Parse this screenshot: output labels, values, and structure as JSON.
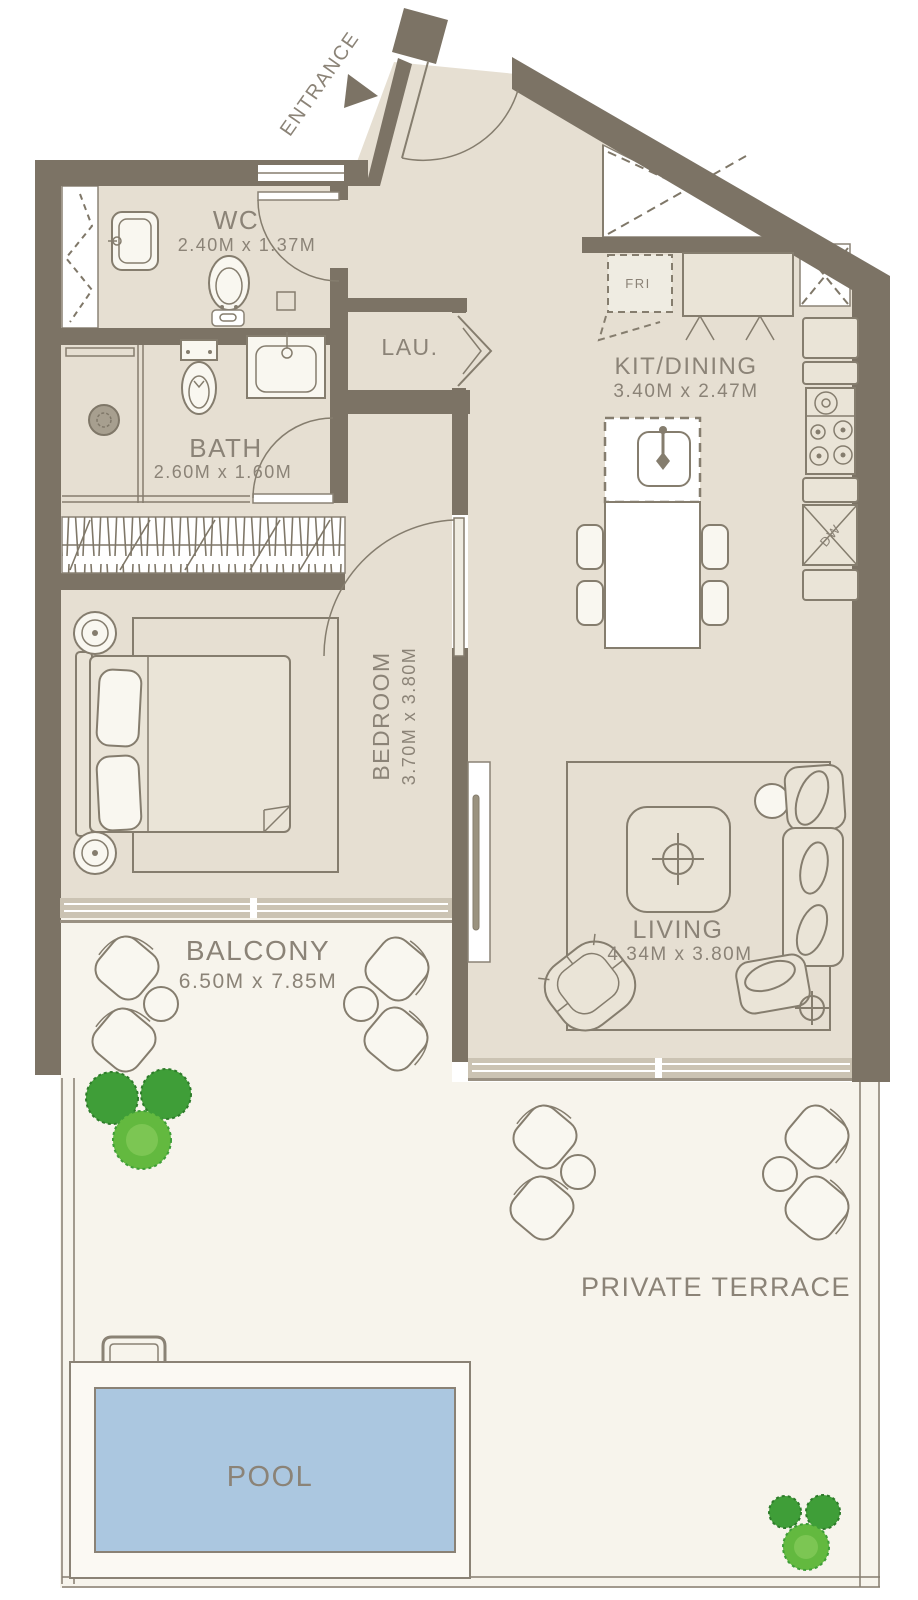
{
  "plan": {
    "entrance": {
      "label": "ENTRANCE"
    },
    "rooms": {
      "wc": {
        "name": "WC",
        "dims": "2.40M x 1.37M"
      },
      "bath": {
        "name": "BATH",
        "dims": "2.60M x 1.60M"
      },
      "laundry": {
        "name": "LAU."
      },
      "kitchen": {
        "name": "KIT/DINING",
        "dims": "3.40M x 2.47M"
      },
      "bedroom": {
        "name": "BEDROOM",
        "dims": "3.70M x 3.80M"
      },
      "living": {
        "name": "LIVING",
        "dims": "4.34M x 3.80M"
      },
      "balcony": {
        "name": "BALCONY",
        "dims": "6.50M x 7.85M"
      },
      "terrace": {
        "name": "PRIVATE TERRACE"
      },
      "pool": {
        "name": "POOL"
      }
    },
    "appliances": {
      "fridge": "FRI",
      "dishwasher": "DW"
    },
    "colors": {
      "wall": "#7c7365",
      "floor": "#e6dfd2",
      "outdoor": "#f7f4ec",
      "pool_water": "#abc7e0",
      "line": "#857d6e",
      "label_text": "#8b8377",
      "plant_dark": "#3f9e38",
      "plant_light": "#63b93f",
      "glass": "#cbc3b3"
    }
  }
}
